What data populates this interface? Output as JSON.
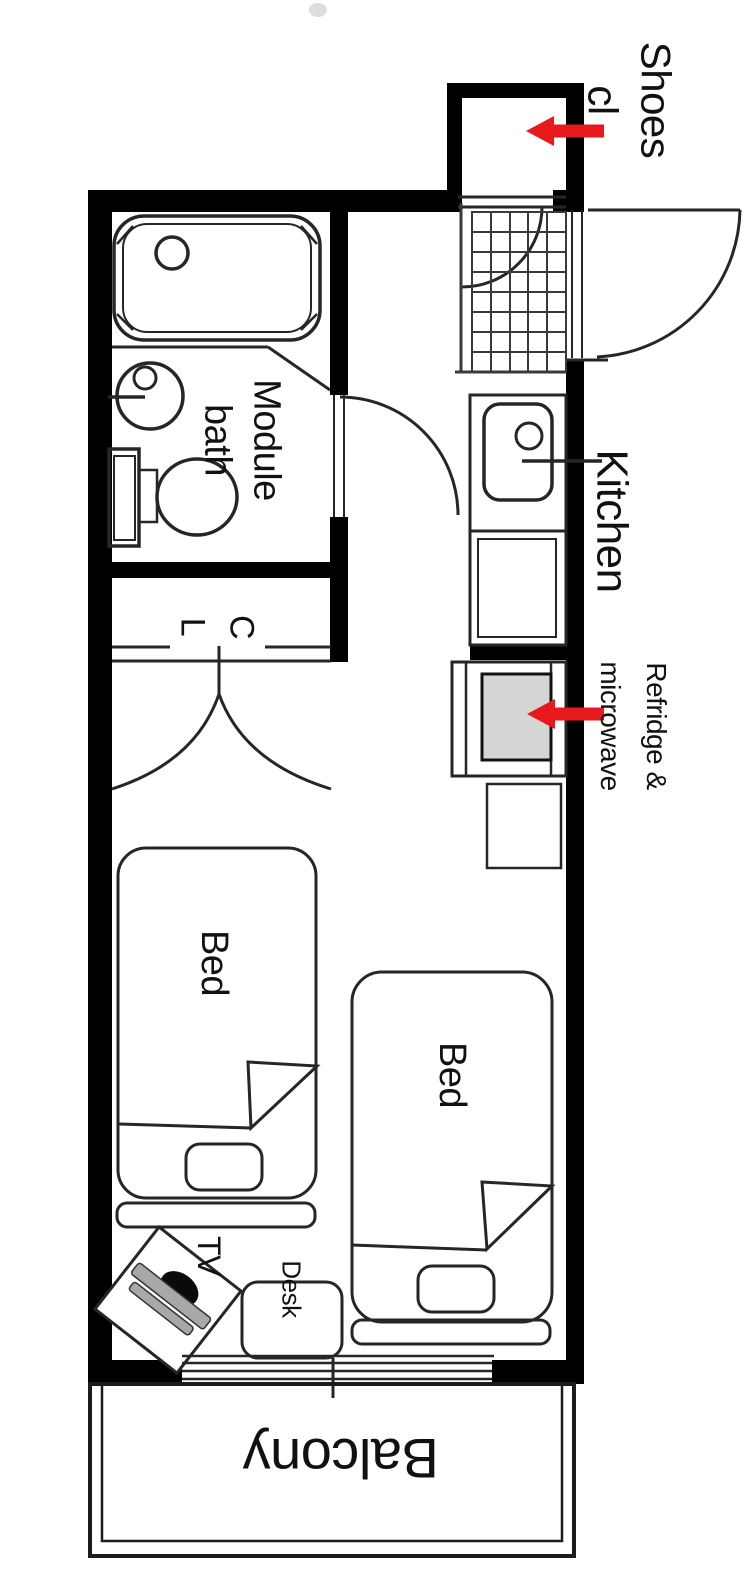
{
  "meta": {
    "type": "apartment-floor-plan",
    "orientation": "rotated-90"
  },
  "colors": {
    "background": "#ffffff",
    "wall": "#000000",
    "line": "#262626",
    "text": "#111111",
    "arrow_red": "#e8191c",
    "appliance_gray": "#d5d5d5",
    "tv_gray": "#a8a8a8"
  },
  "labels": {
    "shoes_closet": "Shoes cl",
    "kitchen": "Kitchen",
    "refrigerator": "Refridge &\nmicrowave",
    "module_bath": "Module\nbath",
    "closet": "C\nL",
    "bed_left": "Bed",
    "bed_right": "Bed",
    "tv": "TV",
    "desk": "Desk",
    "balcony": "Balcony"
  }
}
